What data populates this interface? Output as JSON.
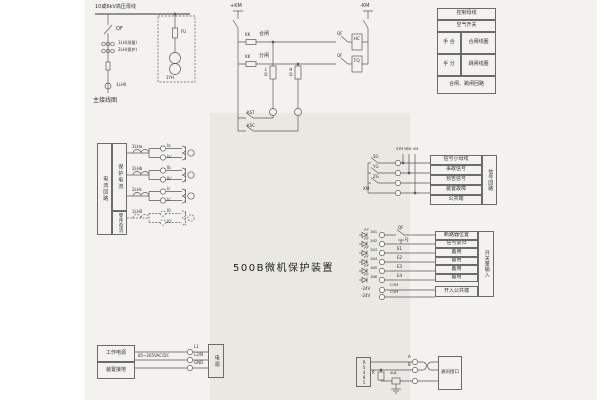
{
  "device_title": "500B微机保护装置",
  "main_diagram": {
    "bus_label": "10或6kV高压母线",
    "breaker": "QF",
    "ct_measure": "1LH(测量)",
    "ct_protect": "2LH(保护)",
    "zero_ct": "1LH0",
    "fuse": "FU",
    "pt": "1YH",
    "caption": "主接线图"
  },
  "control_circuit": {
    "pos_bus": "+KM",
    "neg_bus": "-KM",
    "kk_close": "KK",
    "close_label": "合闸",
    "kk_trip": "KK",
    "trip_label": "分闸",
    "qf_close": "QF",
    "qf_trip": "QF",
    "close_coil": "HC",
    "trip_coil": "TQ",
    "green_lamp": "LD",
    "red_lamp": "HD",
    "manual_trip": "KST",
    "manual_close": "KSC"
  },
  "control_table": {
    "row1": "控制母线",
    "row2": "空气开关",
    "close_left": "手 合",
    "close_right": "合闸线圈",
    "trip_left": "手 分",
    "trip_right": "跳闸线圈",
    "caption": "合闸、跳闸回路"
  },
  "current_block": {
    "col_current": "电流回路",
    "col_protect": "保护电流",
    "col_zero": "零序电流",
    "cts": [
      "2LHa",
      "2LHb",
      "2LHc",
      "1LH0"
    ],
    "terminals": [
      "Ia",
      "Ia'",
      "Ib",
      "Ib'",
      "Ic",
      "Ic'",
      "I0",
      "I0'"
    ]
  },
  "signal_block": {
    "bus_labels": [
      "SYM",
      "YBM",
      "XM"
    ],
    "contacts": [
      "SG",
      "YG",
      "ZG",
      "XM-"
    ],
    "table_header": "信号小母线",
    "rows": [
      "事故信号",
      "预告信号",
      "装置故障",
      "公共端"
    ],
    "side_label": "信号回路"
  },
  "input_block": {
    "opto_labels": [
      "1N1",
      "1N2",
      "1N3",
      "1N4",
      "1N5",
      "1N6"
    ],
    "wire_labels": [
      "QF",
      "FJ",
      "E1",
      "E2",
      "E3",
      "E4"
    ],
    "power_labels": [
      "-24V",
      "-24V"
    ],
    "power_wire_labels": [
      "COM",
      "COM"
    ],
    "rows": [
      "断路器位置",
      "信号复归",
      "备用",
      "备用",
      "备用",
      "备用"
    ],
    "common_row": "开入公共端",
    "side_label": "开关量输入"
  },
  "power_block": {
    "cell_power": "工作电源",
    "cell_ground": "装置接地",
    "wire_label": "85~265VAC/DC",
    "terminals": [
      "L1",
      "L2/N",
      "GND"
    ],
    "box_label": "电源"
  },
  "comm_block": {
    "box_label": "RS485",
    "resistor": "R",
    "arrester": "4LB",
    "wire_a": "A",
    "wire_b": "B",
    "interface": "通讯接口"
  }
}
